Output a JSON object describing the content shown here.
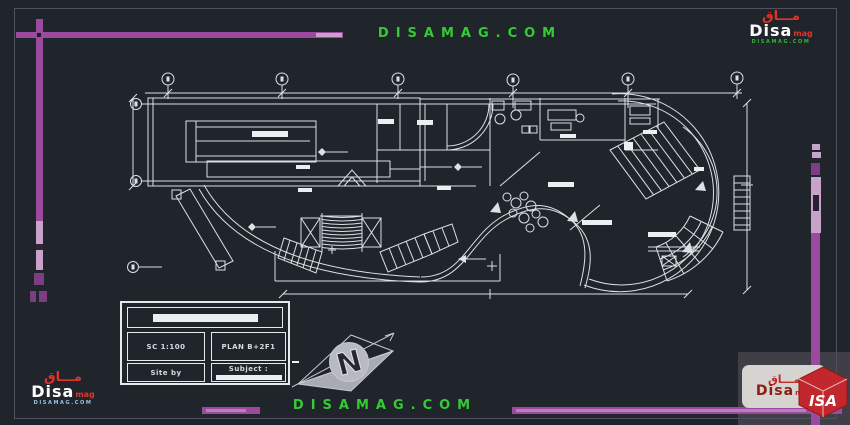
{
  "watermarks": {
    "top": "DISAMAG.COM",
    "bottom": "DISAMAG.COM"
  },
  "logos": {
    "top_right": {
      "arabic": "مـــاق",
      "name": "Disa",
      "suffix": "mag",
      "site": "DISAMAG.COM"
    },
    "bottom_left": {
      "arabic": "مـــاق",
      "name": "Disa",
      "suffix": "mag",
      "site": "DISAMAG.COM"
    },
    "bottom_right": {
      "arabic": "مـــاق",
      "name": "Disa",
      "suffix": "mag",
      "cube_text": "ISA"
    }
  },
  "title_block": {
    "scale": "SC  1:100",
    "plan": "PLAN B+2F1",
    "site": "Site by",
    "subject": "Subject :"
  },
  "north": {
    "letter": "N"
  },
  "drawing": {
    "type": "architectural floor plan (CAD)",
    "grid_bubbles_top": 6,
    "grid_bubbles_left": 3
  },
  "colors": {
    "background": "#20242b",
    "line": "#dde1e5",
    "accent_purple": "#9b4a9d",
    "accent_purple_light": "#c9a2cb",
    "watermark_green": "#35cb35",
    "logo_red": "#e0342b"
  }
}
